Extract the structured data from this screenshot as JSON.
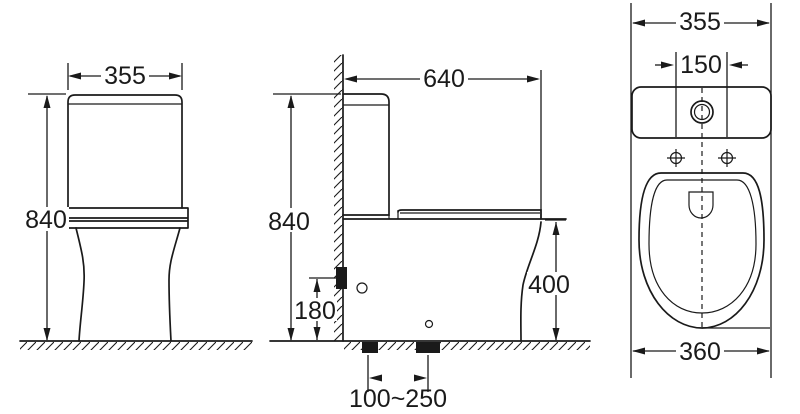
{
  "page": {
    "background": "#ffffff",
    "line_color": "#1a1a1a",
    "description": "Three-view technical dimension drawing of a two-piece toilet"
  },
  "views": {
    "front": {
      "tank_width": "355",
      "overall_height": "840"
    },
    "side": {
      "overall_depth": "640",
      "overall_height": "840",
      "inlet_height": "180",
      "rim_height": "400",
      "outlet_distance_range": "100~250"
    },
    "top": {
      "tank_width": "355",
      "button_offset": "150",
      "bowl_width": "360"
    }
  }
}
